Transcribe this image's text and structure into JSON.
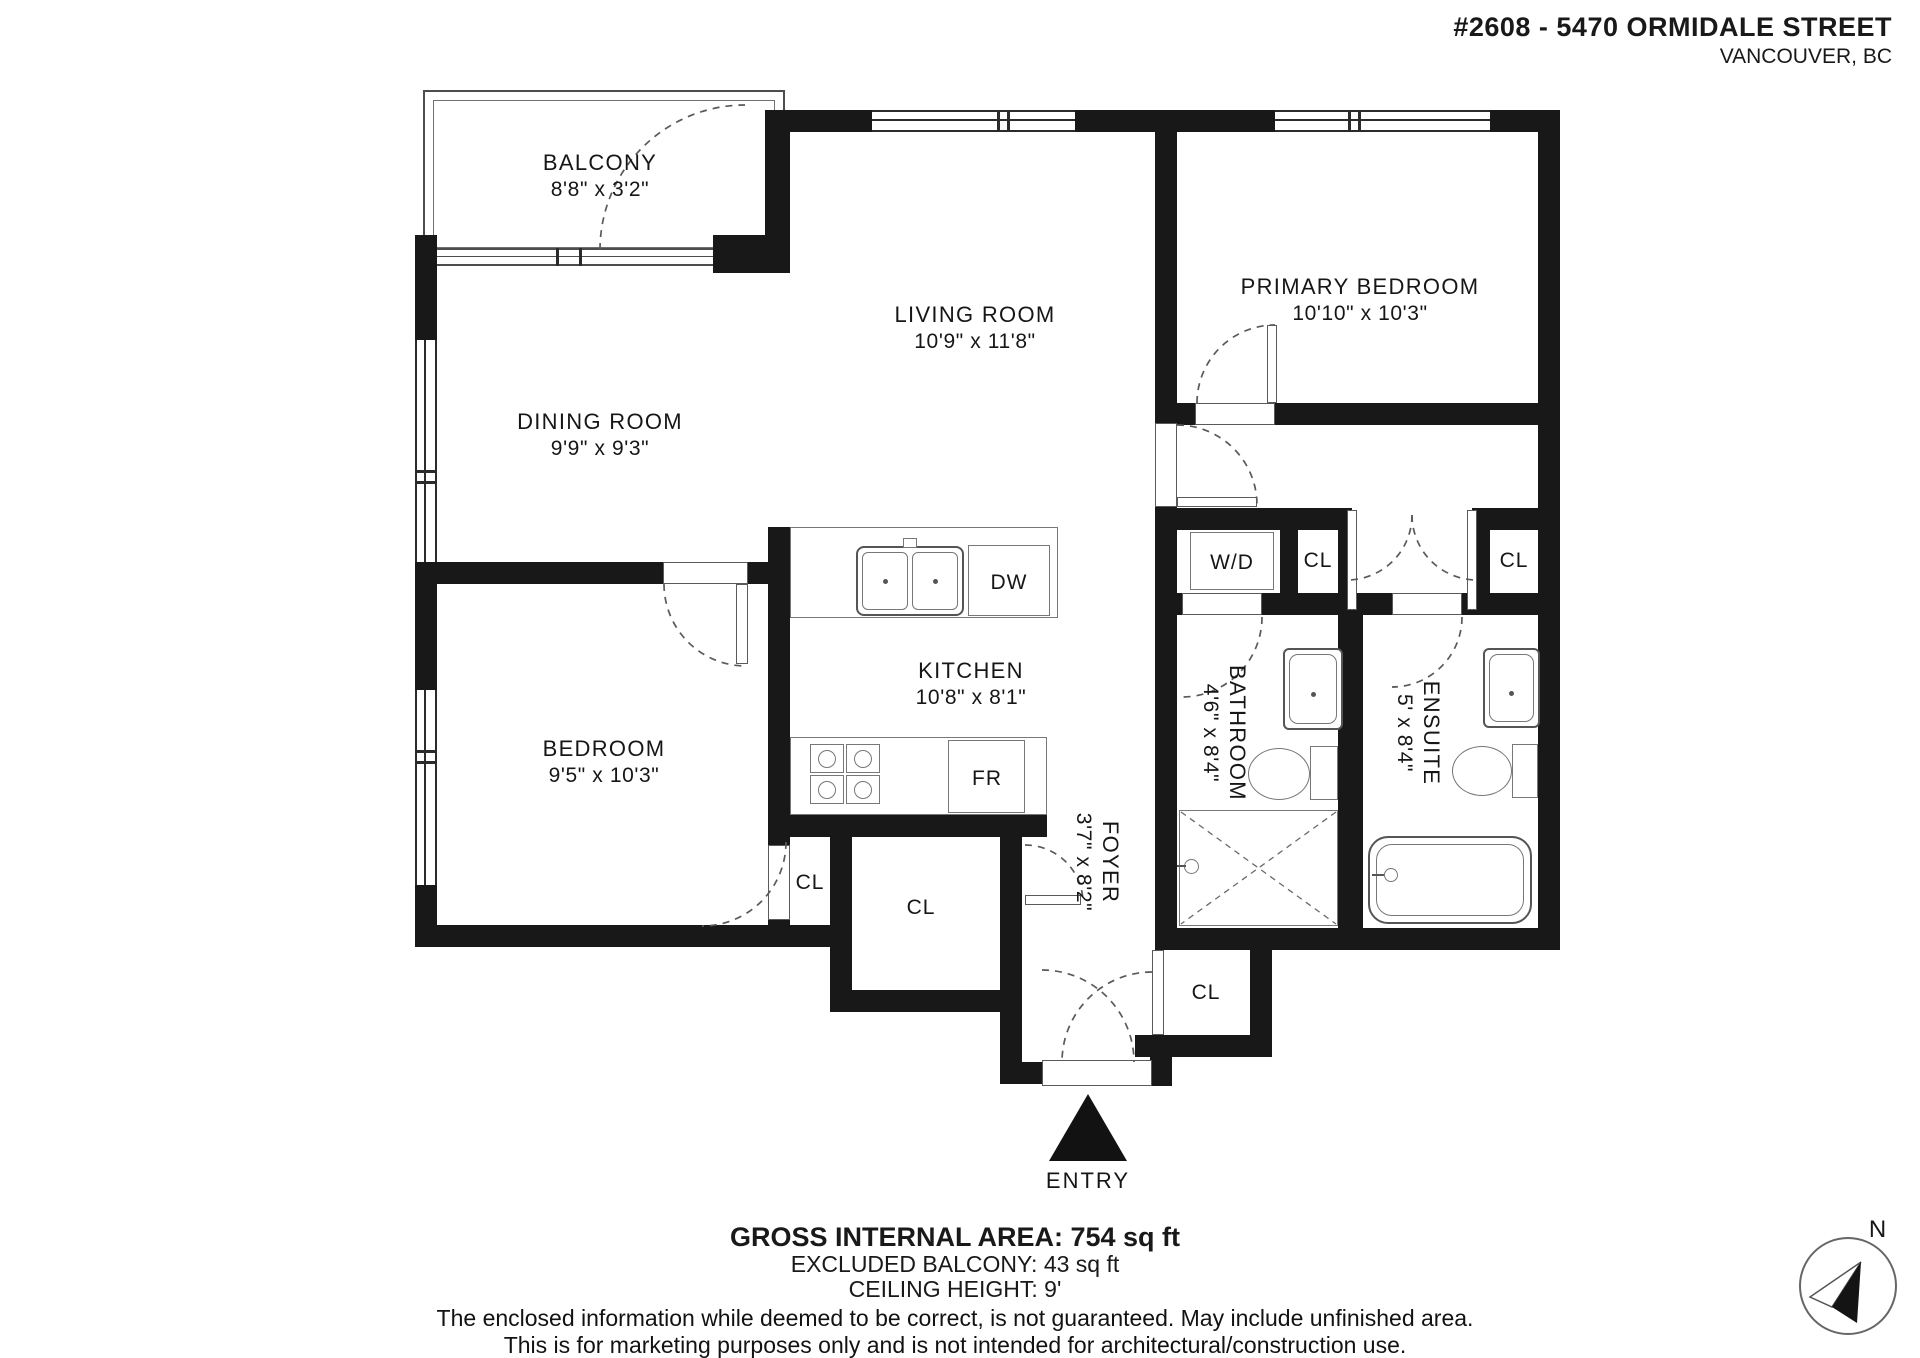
{
  "header": {
    "address_line1": "#2608 - 5470 ORMIDALE STREET",
    "address_line2": "VANCOUVER, BC"
  },
  "rooms": {
    "balcony": {
      "name": "BALCONY",
      "dims": "8'8\" x 3'2\""
    },
    "living": {
      "name": "LIVING ROOM",
      "dims": "10'9\" x 11'8\""
    },
    "dining": {
      "name": "DINING ROOM",
      "dims": "9'9\" x 9'3\""
    },
    "primary": {
      "name": "PRIMARY BEDROOM",
      "dims": "10'10\" x 10'3\""
    },
    "bedroom": {
      "name": "BEDROOM",
      "dims": "9'5\" x 10'3\""
    },
    "kitchen": {
      "name": "KITCHEN",
      "dims": "10'8\" x 8'1\""
    },
    "bathroom": {
      "name": "BATHROOM",
      "dims": "4'6\" x 8'4\""
    },
    "ensuite": {
      "name": "ENSUITE",
      "dims": "5' x 8'4\""
    },
    "foyer": {
      "name": "FOYER",
      "dims": "3'7\" x 8'2\""
    }
  },
  "labels": {
    "closet": "CL",
    "washer_dryer": "W/D",
    "dishwasher": "DW",
    "fridge": "FR",
    "entry": "ENTRY",
    "north": "N"
  },
  "summary": {
    "line1": "GROSS INTERNAL AREA: 754 sq ft",
    "line2": "EXCLUDED BALCONY: 43 sq ft",
    "line3": "CEILING HEIGHT: 9'"
  },
  "disclaimer": {
    "line1": "The enclosed information while deemed to be correct, is not guaranteed. May include unfinished area.",
    "line2": "This is for marketing purposes only and is not intended for architectural/construction use."
  },
  "colors": {
    "wall": "#181818",
    "line": "#555555",
    "text": "#161616"
  }
}
